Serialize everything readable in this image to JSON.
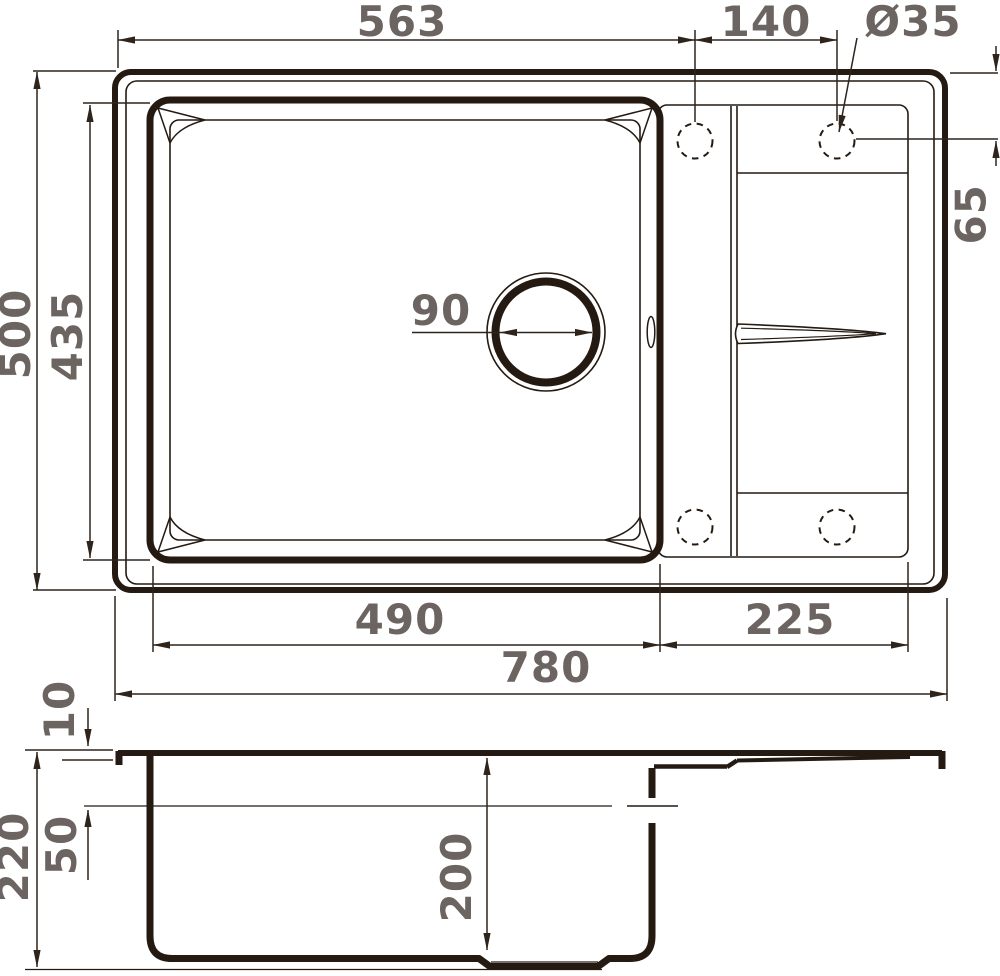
{
  "colors": {
    "line": "#241a12",
    "dim_line": "#2e241b",
    "dim_text": "#6b6461",
    "background": "#ffffff"
  },
  "top_view": {
    "dim_left_edge_to_hole": "563",
    "dim_hole_spacing": "140",
    "dim_hole_diameter": "Ø35",
    "dim_hole_offset_from_top": "65",
    "dim_overall_depth": "500",
    "dim_bowl_outer_depth": "435",
    "dim_drain_diameter": "90",
    "dim_bowl_width": "490",
    "dim_drainboard_width": "225",
    "dim_overall_width": "780"
  },
  "section_view": {
    "dim_rim_thickness": "10",
    "dim_overall_height": "220",
    "dim_ledge_depth": "50",
    "dim_bowl_depth": "200"
  }
}
